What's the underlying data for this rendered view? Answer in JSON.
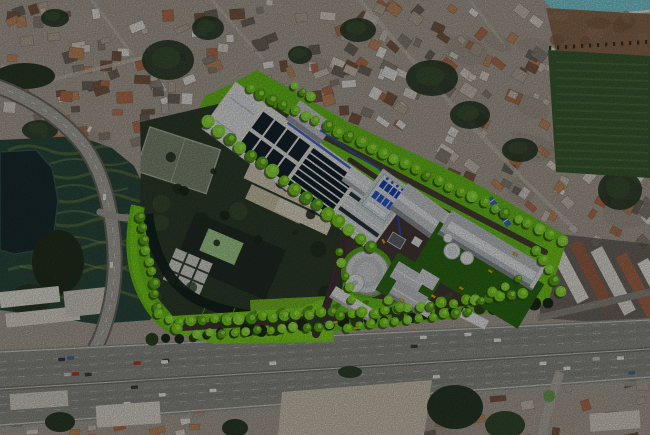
{
  "scene": {
    "type": "satellite-aerial-photo-with-site-plan-render",
    "description": "Aerial satellite photograph of a dense urban district with an architectural master-plan rendering of a water treatment facility overlaid: bright green landscaped campus with treatment basin banks, process buildings, storage tanks and a round reservoir, bounded by a riverside park and curved highway ramp on the west and a multi-lane toll highway on the south.",
    "visible_text": []
  },
  "palette": {
    "urban_base": "#aaa195",
    "asphalt": "#8e8f89",
    "highway_median": "#75776f",
    "render_green": "#6abf1e",
    "render_green_light": "#7cd11f",
    "garden_teal": "#2b4a3e",
    "garden_swirl": "#77883e",
    "lake": "#1b2d2f",
    "river": "#14231c",
    "pool": "#7fd0d8",
    "dirt": "#8a6a4e",
    "campus_dark": "#2e3d2b",
    "sand": "#cfc6b4",
    "site_road": "#453339",
    "basin_dark": "#16242e",
    "pipe_blue": "#2a52c8",
    "building_gray": "#c9ccce",
    "deck_white": "#e9e9e4",
    "tree_green": "#76cc1c",
    "tree_shadow": "#2c4a10",
    "truck_yellow": "#e0a81c",
    "veg_dark": "#293a27",
    "roof_orange": "#b5714f",
    "warehouse_rust": "#9c6248"
  },
  "site_plan": {
    "elements": [
      "treatment-basin-complex",
      "covered-filter-roofs",
      "dosing-unit-blue",
      "process-building",
      "long-warehouse-building",
      "storage-tanks",
      "round-reservoir-building",
      "gable-roof-cluster",
      "substation",
      "gatehouse",
      "pipe-bridge",
      "perimeter-tree-rows",
      "internal-roads",
      "service-trucks",
      "lawn-areas"
    ]
  },
  "context": {
    "features": [
      "dense-housing-district",
      "elevated-highway-ramp",
      "riverside-park",
      "lake",
      "vegetable-garden-plots",
      "toll-highway",
      "frontage-road",
      "swimming-pool",
      "construction-dirt-lot",
      "warehouse-row",
      "school-campus-enclave"
    ]
  }
}
